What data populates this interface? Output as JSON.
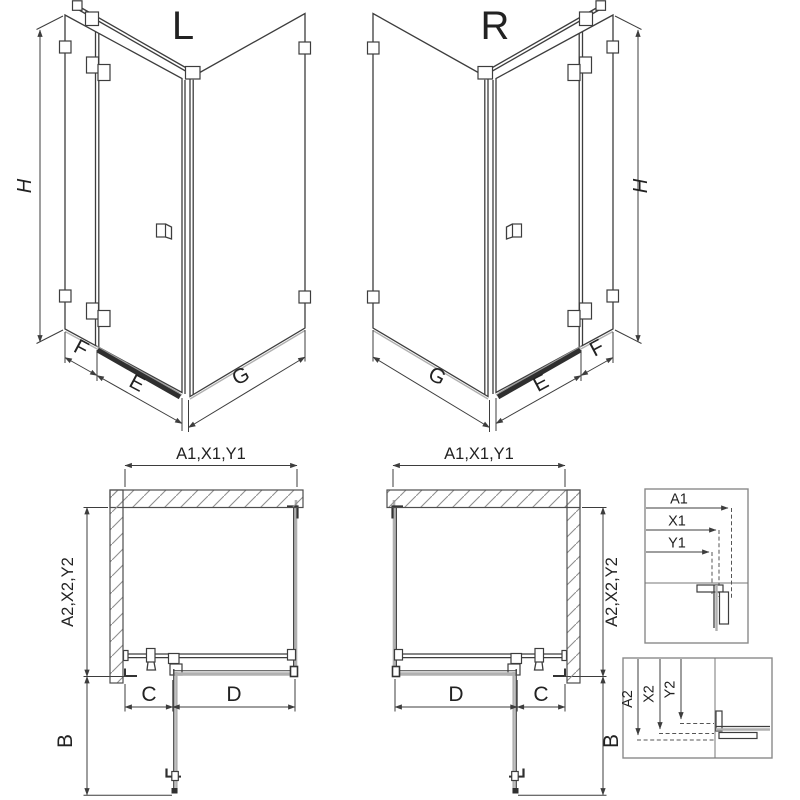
{
  "diagram": {
    "iso_left": {
      "title": "L",
      "dim_height": "H",
      "dim_fixed": "F",
      "dim_door": "E",
      "dim_side": "G"
    },
    "iso_right": {
      "title": "R",
      "dim_height": "H",
      "dim_fixed": "F",
      "dim_door": "E",
      "dim_side": "G"
    },
    "plan_left": {
      "dim_width": "A1,X1,Y1",
      "dim_depth": "A2,X2,Y2",
      "dim_c": "C",
      "dim_d": "D",
      "dim_b": "B"
    },
    "plan_right": {
      "dim_width": "A1,X1,Y1",
      "dim_depth": "A2,X2,Y2",
      "dim_c": "C",
      "dim_d": "D",
      "dim_b": "B"
    },
    "detail_width": {
      "labels": [
        "A1",
        "X1",
        "Y1"
      ]
    },
    "detail_depth": {
      "labels": [
        "A2",
        "X2",
        "Y2"
      ]
    },
    "colors": {
      "line": "#3d3d3d",
      "glass_gray": "#b0b0b0",
      "box_border": "#8a8a8a",
      "background": "#ffffff"
    }
  }
}
